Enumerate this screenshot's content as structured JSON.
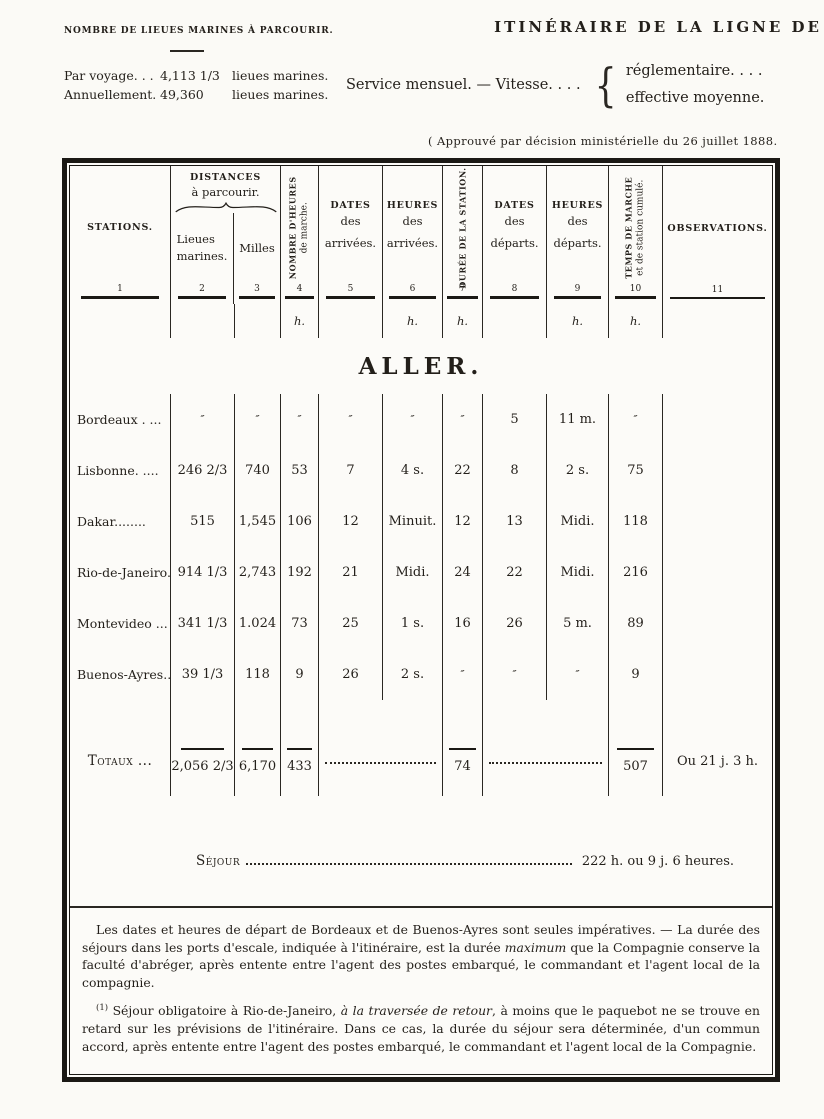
{
  "ink_color": "#231f1a",
  "paper_color": "#fbfaf6",
  "header": {
    "leagues_title": "NOMBRE DE LIEUES MARINES À PARCOURIR.",
    "leagues_rows": [
      {
        "label": "Par voyage. . .",
        "value": "4,113 1/3",
        "unit": "lieues marines."
      },
      {
        "label": "Annuellement.",
        "value": "49,360",
        "unit": "lieues marines."
      }
    ],
    "itinerary_title": "ITINÉRAIRE DE LA LIGNE DE",
    "service_line": "Service mensuel. — Vitesse. . . .",
    "vitesse_options": [
      "réglementaire. . . .",
      "effective moyenne."
    ],
    "approval": "( Approuvé par décision ministérielle du 26 juillet 1888."
  },
  "table": {
    "columns": {
      "stations": "STATIONS.",
      "distances": [
        "DISTANCES",
        "à parcourir."
      ],
      "lieues": [
        "Lieues",
        "marines."
      ],
      "milles": "Milles",
      "heures_marche": [
        "NOMBRE D'HEURES",
        "de marche."
      ],
      "dates_arrivees": [
        "DATES",
        "des",
        "arrivées."
      ],
      "heures_arrivees": [
        "HEURES",
        "des",
        "arrivées."
      ],
      "duree_station": "DURÉE DE LA STATION.",
      "dates_departs": [
        "DATES",
        "des",
        "départs."
      ],
      "heures_departs": [
        "HEURES",
        "des",
        "départs."
      ],
      "temps_cumule": [
        "TEMPS DE MARCHE",
        "et de station cumulé."
      ],
      "observations": "OBSERVATIONS.",
      "numbers": [
        "1",
        "2",
        "3",
        "4",
        "5",
        "6",
        "7",
        "8",
        "9",
        "10",
        "11"
      ],
      "unit_h": "h."
    },
    "section_title": "ALLER.",
    "rows": [
      {
        "station": "Bordeaux . ...",
        "lieues": "″",
        "milles": "″",
        "marche": "″",
        "date_arr": "″",
        "heure_arr": "″",
        "duree": "″",
        "date_dep": "5",
        "heure_dep": "11 m.",
        "temps": "″",
        "obs": ""
      },
      {
        "station": "Lisbonne. ....",
        "lieues": "246 2/3",
        "milles": "740",
        "marche": "53",
        "date_arr": "7",
        "heure_arr": "4 s.",
        "duree": "22",
        "date_dep": "8",
        "heure_dep": "2 s.",
        "temps": "75",
        "obs": ""
      },
      {
        "station": "Dakar........",
        "lieues": "515",
        "milles": "1,545",
        "marche": "106",
        "date_arr": "12",
        "heure_arr": "Minuit.",
        "duree": "12",
        "date_dep": "13",
        "heure_dep": "Midi.",
        "temps": "118",
        "obs": ""
      },
      {
        "station": "Rio-de-Janeiro.",
        "lieues": "914 1/3",
        "milles": "2,743",
        "marche": "192",
        "date_arr": "21",
        "heure_arr": "Midi.",
        "duree": "24",
        "date_dep": "22",
        "heure_dep": "Midi.",
        "temps": "216",
        "obs": ""
      },
      {
        "station": "Montevideo ...",
        "lieues": "341 1/3",
        "milles": "1.024",
        "marche": "73",
        "date_arr": "25",
        "heure_arr": "1 s.",
        "duree": "16",
        "date_dep": "26",
        "heure_dep": "5 m.",
        "temps": "89",
        "obs": ""
      },
      {
        "station": "Buenos-Ayres..",
        "lieues": "39 1/3",
        "milles": "118",
        "marche": "9",
        "date_arr": "26",
        "heure_arr": "2 s.",
        "duree": "″",
        "date_dep": "″",
        "heure_dep": "″",
        "temps": "9",
        "obs": ""
      }
    ],
    "totals": {
      "label": "Totaux ...",
      "lieues": "2,056 2/3",
      "milles": "6,170",
      "marche": "433",
      "duree": "74",
      "temps": "507",
      "obs": "Ou 21 j. 3 h."
    },
    "sejour": {
      "label": "Séjour",
      "value": "222 h. ou 9 j. 6 heures."
    }
  },
  "footnotes": {
    "p1_pre": "Les dates et heures de départ de Bordeaux et de Buenos-Ayres sont seules impératives. — La durée des séjours dans les ports d'escale, indiquée à l'itinéraire, est la durée ",
    "p1_italic": "maximum",
    "p1_post": " que la Compagnie conserve la faculté d'abréger, après entente entre l'agent des postes embarqué, le commandant et l'agent local de la compagnie.",
    "p2_marker": "(1)",
    "p2_pre": " Séjour obligatoire à Rio-de-Janeiro, ",
    "p2_italic": "à la traversée de retour",
    "p2_post": ", à moins que le paquebot ne se trouve en retard sur les prévisions de l'itinéraire. Dans ce cas, la durée du séjour sera déterminée, d'un commun accord, après entente entre l'agent des postes embarqué, le commandant et l'agent local de la Compagnie."
  }
}
